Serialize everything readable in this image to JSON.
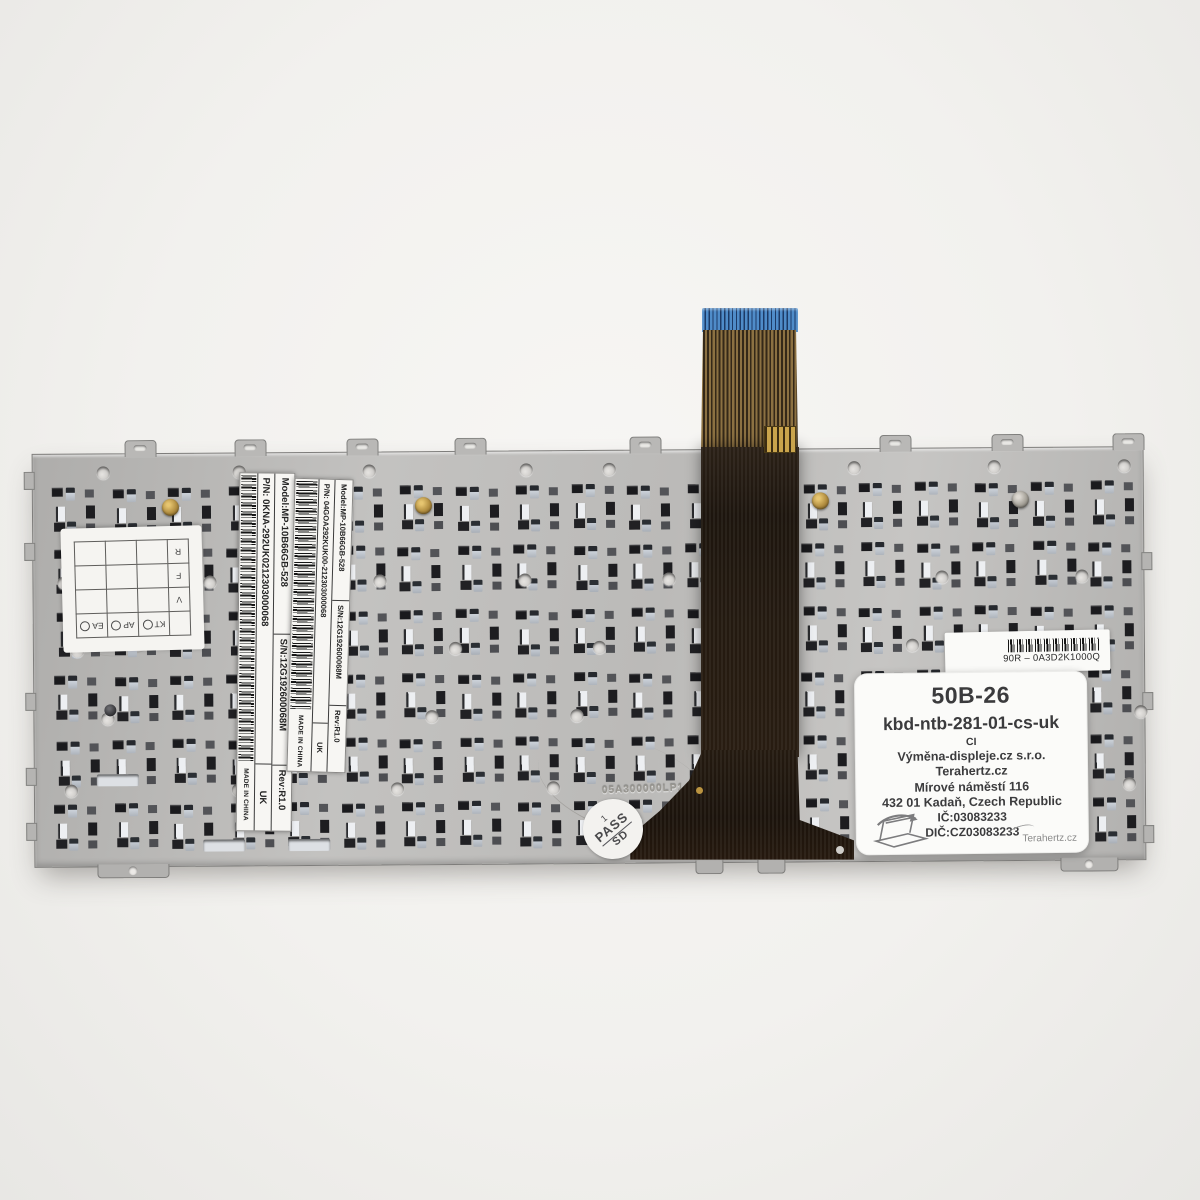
{
  "plate": {
    "embossed_code": "05A300000LP1 01"
  },
  "stickers": {
    "qc_grid": {
      "columns": [
        "KT",
        "AP",
        "EA"
      ],
      "rows": [
        "V",
        "F",
        "R"
      ]
    },
    "label_a": {
      "model": "Model:MP-10B66GB-528",
      "serial": "S/N:12G192600068M",
      "rev": "Rev:R1.0",
      "pn": "P/N:  0KNA-292UK0212303000068",
      "country": "UK",
      "made": "MADE IN CHINA"
    },
    "label_b": {
      "model": "Model:MP-10B66GB-528",
      "serial": "S/N:12G192600068M",
      "rev": "Rev:R1.0",
      "pn": "P/N:  04GOA292KUK00-212303000068",
      "country": "UK",
      "made": "MADE IN CHINA"
    },
    "barcode_label": {
      "code": "90R – 0A3D2K1000Q"
    },
    "pass_stamp": {
      "line1": "1",
      "line2": "PASS",
      "line3": "SD"
    },
    "seller_label": {
      "line1": "50B-26",
      "line2": "kbd-ntb-281-01-cs-uk",
      "line3": "CI",
      "line4": "Výměna-displeje.cz s.r.o.",
      "line5": "Terahertz.cz",
      "line6": "Mírové náměstí 116",
      "line7": "432 01 Kadaň, Czech Republic",
      "line8": "IČ:03083233",
      "line9": "DIČ:CZ03083233",
      "signature": "Terahertz.cz"
    }
  }
}
